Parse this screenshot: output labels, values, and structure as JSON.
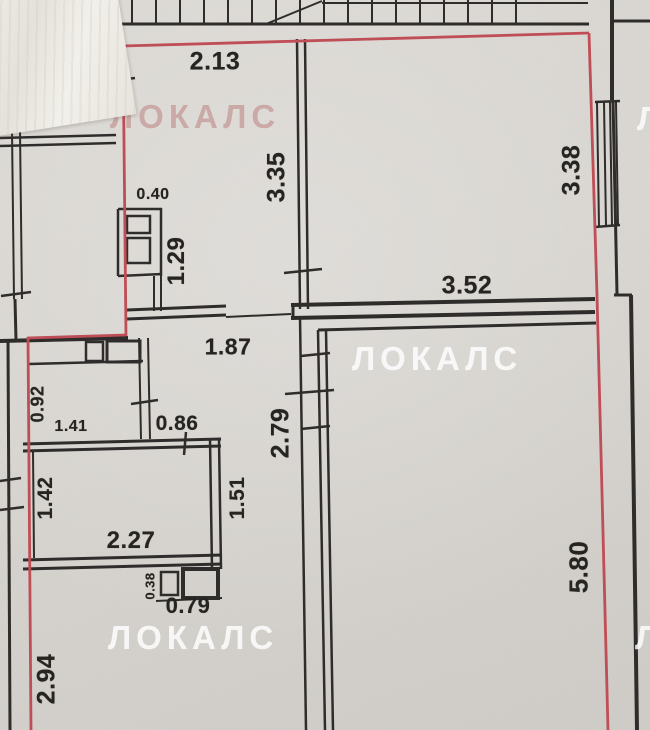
{
  "plan": {
    "watermark": "ЛОКАЛС",
    "watermark_partial": "Л",
    "dimensions": {
      "top_left_room_width": "2.13",
      "top_left_room_depth": "3.35",
      "top_right_room_depth": "3.38",
      "vent_shaft_width": "0.40",
      "vent_shaft_depth": "1.29",
      "living_room_width": "3.52",
      "hall_top_width": "1.87",
      "wc_depth": "0.92",
      "wc_width": "1.41",
      "niche_width": "0.86",
      "corridor_depth": "2.79",
      "bathroom_depth": "1.42",
      "corridor_lower_depth": "1.51",
      "bathroom_width": "2.27",
      "duct_depth": "0.38",
      "duct_width": "0.79",
      "living_room_depth": "5.80",
      "hall_depth": "2.94"
    },
    "colors": {
      "boundary_red": "#bf4a53",
      "wall_black": "#2a2826",
      "paper": "#d8d5d0",
      "watermark_white": "rgba(255,255,255,0.82)",
      "watermark_pink": "rgba(186,132,130,0.60)"
    }
  }
}
